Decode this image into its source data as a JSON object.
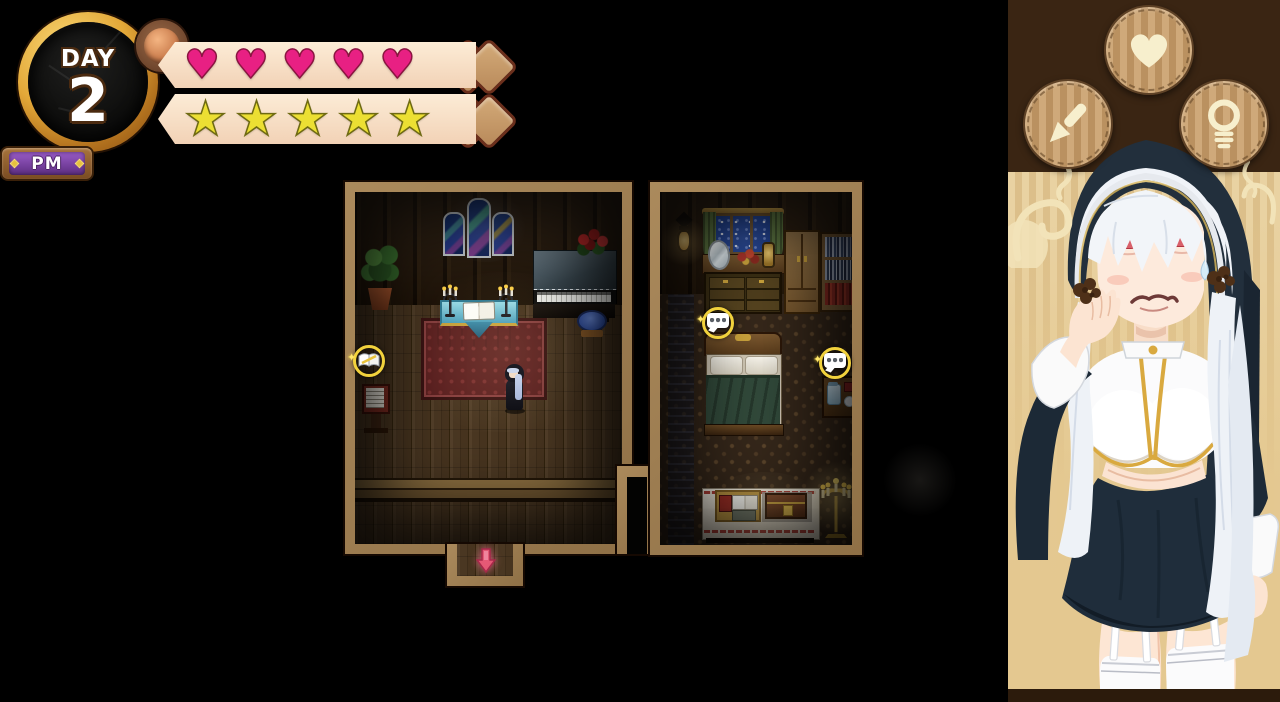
{
  "hud": {
    "day_badge": {
      "label": "DAY",
      "value": "2",
      "meridiem": "PM"
    },
    "hearts": {
      "filled": 5,
      "max": 5,
      "glyph": "♥",
      "icon": "heart-icon",
      "color": "#e82083"
    },
    "stars": {
      "filled": 5,
      "max": 5,
      "glyph": "★",
      "icon": "star-icon",
      "color": "#ecdf33"
    }
  },
  "map": {
    "markers": [
      {
        "icon": "open-book-marker",
        "location": "chapel-sign"
      },
      {
        "icon": "speech-bubble-marker",
        "location": "bedroom-bed"
      },
      {
        "icon": "speech-bubble-marker",
        "location": "bedroom-nightstand"
      },
      {
        "icon": "exit-arrow-icon",
        "location": "chapel-south-door"
      }
    ],
    "player": {
      "sprite": "nun-player-sprite"
    }
  },
  "side_panel": {
    "buttons": [
      {
        "icon": "heart-icon"
      },
      {
        "icon": "pencil-icon"
      },
      {
        "icon": "lightbulb-icon"
      }
    ],
    "portrait": "nun-portrait"
  },
  "colors": {
    "background": "#000000",
    "hud_banner": "#f7dfc5",
    "heart": "#e82083",
    "star": "#ecdf33",
    "wall_border": "#9c7c50",
    "panel_header": "#3a2513",
    "panel_stripe_light": "#e9d2a2",
    "panel_stripe_dark": "#dcbf8a",
    "marker_ring": "#f2d23c",
    "pm_purple": "#7b3fa0",
    "clock_gold": "#e3a838"
  }
}
